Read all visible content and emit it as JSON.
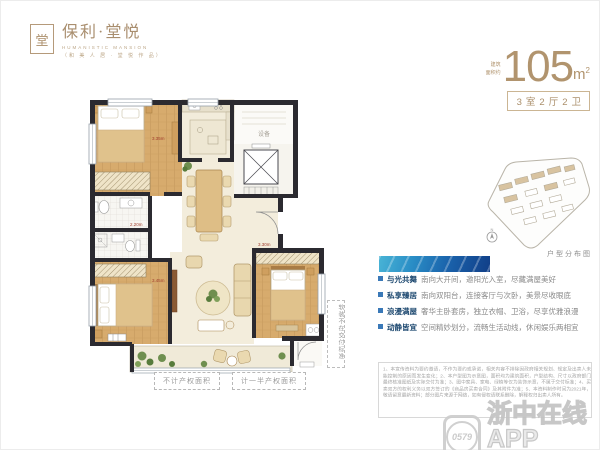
{
  "brand": {
    "seal": "堂",
    "name": "保利·堂悦",
    "en": "HUMANISTIC MANSION",
    "sub": "（和 美 人 居 · 堂 悦 作 品）"
  },
  "area": {
    "prefix1": "建筑",
    "prefix2": "面积约",
    "value": "105",
    "unit_m": "m",
    "unit_sup": "2",
    "tag": "3室2厅2卫"
  },
  "siteplan": {
    "caption": "户型分布图"
  },
  "features": [
    {
      "title": "与光共舞",
      "desc": "南向大开间，邀阳光入室，尽藏满屋美好"
    },
    {
      "title": "私享臻居",
      "desc": "南向双阳台，连接客厅与次卧，美景尽收眼底"
    },
    {
      "title": "浪漫满屋",
      "desc": "奢华主卧套房，独立衣帽、卫浴，尽享优雅浪漫"
    },
    {
      "title": "动静皆宜",
      "desc": "空间精妙划分，流畅生活动线，休闲娱乐两相宜"
    }
  ],
  "floorplan": {
    "legend": [
      "不计产权面积",
      "计一半产权面积"
    ],
    "side_note": "软装不在交付标准",
    "equip": "设备",
    "dims": [
      "3.35m",
      "2.20m",
      "3.45m",
      "3.30m"
    ]
  },
  "disclaimer": {
    "text": "1、本宣传资料为要约邀请，不作为要约或承诺，相关内容不排除因政府相关规划、规定及出卖人未能控制的原因而发生变化；2、本户型图为示意图，面积均为建筑面积，户型结构、尺寸以政府部门最终核准图纸及实际交付为准；3、图中家具、家电、绿植等仅为装饰示意，不属于交付标准；4、买卖双方的权利义务以双方签订的《商品房买卖合同》及其附件为准；5、本资料制作时间为2021年，敬请留意最新资料；部分图片来源于网络，如有侵权请联系删除，解释权归出卖人所有。"
  },
  "watermark": {
    "code": "0579",
    "title": "浙中在线APP",
    "subtitle": "就在你身边"
  }
}
